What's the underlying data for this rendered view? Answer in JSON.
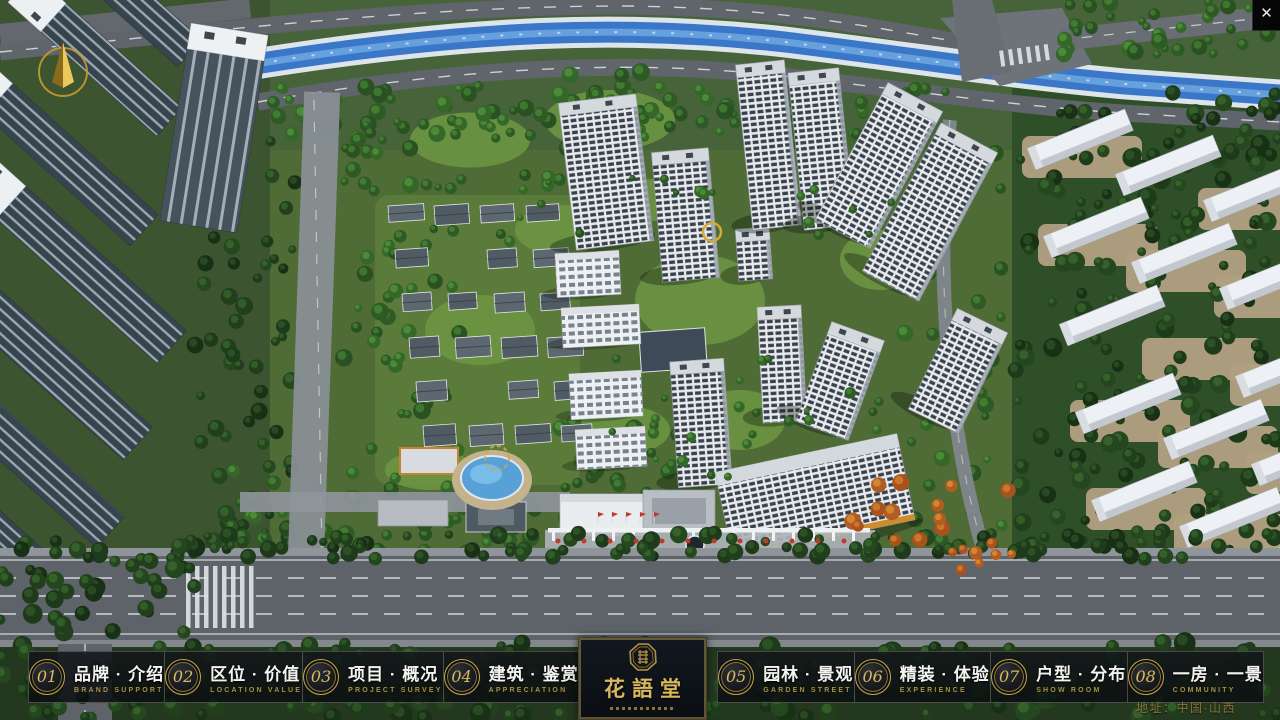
{
  "window": {
    "close_glyph": "✕"
  },
  "icons": {
    "compass": "north-arrow-compass",
    "close": "close-x-icon",
    "seal": "octagon-seal-emblem"
  },
  "nav": {
    "items": [
      {
        "num": "01",
        "zh": "品牌 · 介绍",
        "en": "BRAND SUPPORT"
      },
      {
        "num": "02",
        "zh": "区位 · 价值",
        "en": "LOCATION VALUE"
      },
      {
        "num": "03",
        "zh": "项目 · 概况",
        "en": "PROJECT SURVEY"
      },
      {
        "num": "04",
        "zh": "建筑 · 鉴赏",
        "en": "APPRECIATION"
      },
      {
        "num": "05",
        "zh": "园林 · 景观",
        "en": "GARDEN STREET"
      },
      {
        "num": "06",
        "zh": "精装 · 体验",
        "en": "EXPERIENCE"
      },
      {
        "num": "07",
        "zh": "户型 · 分布",
        "en": "SHOW ROOM"
      },
      {
        "num": "08",
        "zh": "一房 · 一景",
        "en": "COMMUNITY"
      }
    ]
  },
  "logo": {
    "title": "花語堂"
  },
  "footer": {
    "address": "地址：中国·山西"
  },
  "colors": {
    "gold": "#c9a84c",
    "gold_dark": "#8a7434",
    "panel_border": "rgba(190,190,178,0.32)",
    "river": "#3a77c9"
  }
}
